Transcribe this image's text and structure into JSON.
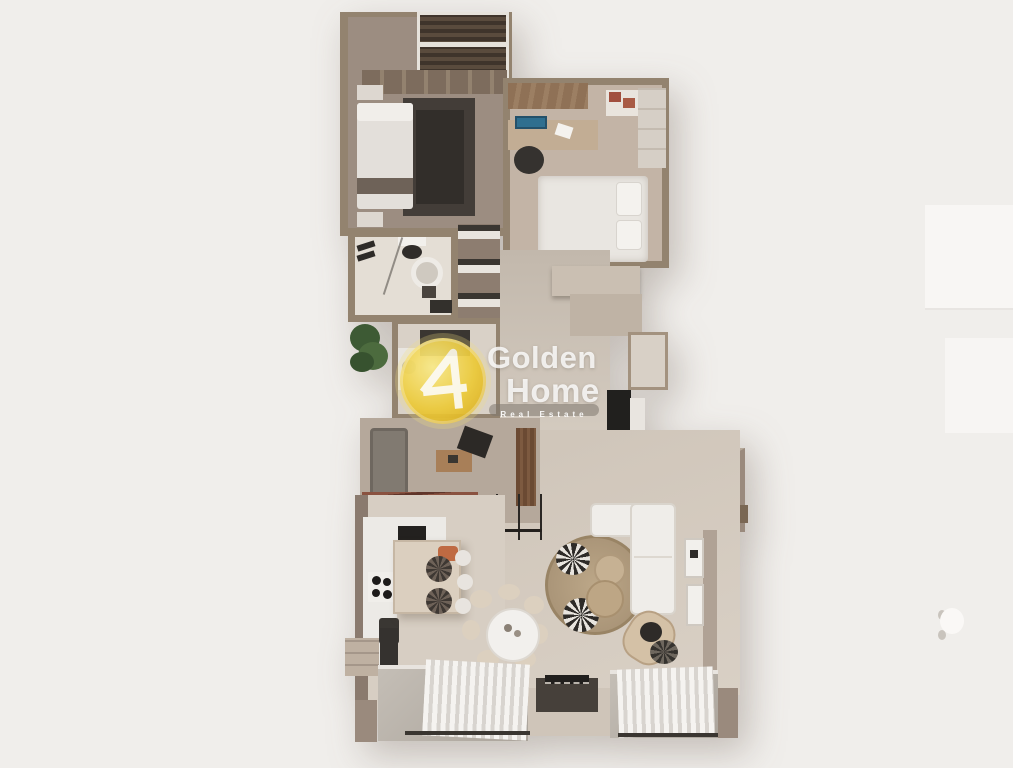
{
  "scene": {
    "description": "3D rendered top-down floor plan of a two-bedroom apartment (real estate render)",
    "background_color": "#f0eeeb",
    "rooms": [
      "master-bedroom",
      "second-bedroom",
      "bathroom",
      "utility-room",
      "hallway",
      "balcony-sitting-area",
      "kitchen",
      "dining-area",
      "living-room",
      "hanging-chair-nook",
      "entrance"
    ]
  },
  "watermark": {
    "brand_line1": "Golden",
    "brand_line2": "Home",
    "tagline": "Real Estate",
    "badge_color": "#e9c52f",
    "text_color": "#ffffff"
  },
  "palette": {
    "wall": "#93836f",
    "wall_light": "#c6b8ab",
    "floor_warm": "#d3c9be",
    "floor_cool": "#9c8d81",
    "pergola_wood_dark": "#4a3c30",
    "pergola_wood_red": "#7c4636",
    "dark_furniture": "#2e2b28",
    "white_furniture": "#efede9",
    "rug_jute": "#b09c80",
    "plant_green": "#44613a",
    "monitor_blue": "#2f6f8f"
  }
}
